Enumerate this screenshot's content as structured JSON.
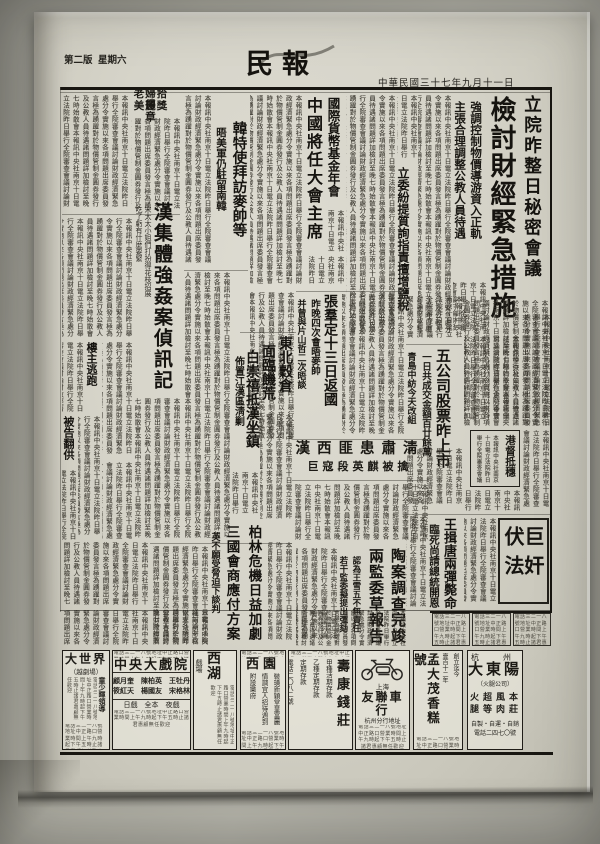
{
  "masthead": {
    "edition": "第二版",
    "weekday": "星期六",
    "title": "民報",
    "date_line": "中華民國三十七年九月十一日"
  },
  "texture": {
    "body": "本報訊中央社南京十日電立法院昨日舉行全院審查會議討論財政經濟緊急處分令實施以來各項問題出席委員發言極為踴躍對於物價管制金圓券發行及公教人員待遇諸問題詳加檢討至晚七時始散會",
    "tiny": "電話三二一八號地址中正路口營業時間上午九時起下午五時止諸君惠顧無任歡迎"
  },
  "articles": {
    "lead_kicker": "立院昨整日秘密會議",
    "lead_headline": "檢討財經緊急措施",
    "lead_sub1": "強調控制物價導游資入正軌",
    "lead_sub2": "主張合理調整公教人員待遇",
    "salt_tax": "立委紛提質詢指責擅增鹽稅",
    "imf_kicker": "國際貨幣基金年會",
    "imf_headline": "中國將任大會主席",
    "korea_headline": "韓特使拜訪麥帥等",
    "korea_sub": "晤美軍仍駐留南韓",
    "medal_line1": "老婦拾得",
    "medal_line2": "美麗獎章",
    "rape_headline": "漢集體強姦案偵訊記",
    "rape_intro1": "宋太太小姐們打扮得花枝招展",
    "rape_intro2": "吃了虧有什麼要緊",
    "rape_sub1": "樓主逃跑",
    "rape_sub2": "被告翻供",
    "zhangqun_headline": "張羣定十三日返國",
    "zhangqun_sub1": "昨晚四次會晤麥帥",
    "zhangqun_sub2": "并曾與片山哲二次晤談",
    "granary_line1": "東北穀倉",
    "granary_line2": "面臨饑荒",
    "bai_headline": "白崇禧抵漢坐鎮",
    "bai_sub": "佈置江漢區淸剿",
    "bandit_headline": "漢西匪患肅淸",
    "bandit_sub": "巨寇段英麒被擒",
    "stocks_headline": "五公司股票昨上市",
    "stocks_sub1": "一日共成交金額百廿餘萬",
    "stocks_sub2": "青島中紡今天改組",
    "hk_box": "港督抵穗",
    "traitor_box": "巨奸伏法",
    "traitor_headline": "王揖唐兩彈斃命",
    "traitor_sub": "臨死尚請總統開恩",
    "tao_line1": "陶案調查完竣",
    "tao_line2": "兩監委草報告",
    "tao_sub1": "認為王雪五不無責任",
    "tao_sub2": "若干監委擬提出彈劾",
    "berlin_line1": "柏林危機日益加劇",
    "berlin_line2": "三國會商應付方案",
    "berlin_sub": "英不願受脅迫下談判"
  },
  "ads": {
    "dashijie_name": "大世界",
    "dashijie_sub": "（越劇場）",
    "dashijie_line": "童少暉領導",
    "zhongyang_name": "中央大戲院",
    "zhongyang_cast1": "顧月奎　陳柏英　王牡丹",
    "zhongyang_cast2": "筱紅天　楊國友　宋格林",
    "zhongyang_bottom": "日戲　全本　夜戲",
    "xihu_name": "西湖",
    "xihu_sub": "戲場",
    "xiyuan_name": "西園",
    "xiyuan_line1": "裝璜新穎堂皇富麗",
    "xiyuan_line2": "情調宜人招待週到",
    "xiyuan_line3": "附設樂府",
    "shoukang_name": "壽康錢莊",
    "shoukang_line1": "甲種活期存款",
    "shoukang_line2": "乙種定期存款",
    "shoukang_line3": "定期存款",
    "shoukang_line4": "電話二〇八二號",
    "youlian_region": "上海",
    "youlian_name": "友聯車行",
    "youlian_branch": "杭州分行地址",
    "mengdamao_kicker1": "創立迄今",
    "mengdamao_kicker2": "壹百十二年",
    "mengdamao_name": "孟大茂香糕號",
    "mengdamao_line1": "※土產馳譽",
    "mengdamao_line2": "※獨步第一",
    "dadongyang_region": "杭　州",
    "dadongyang_name": "大東陽",
    "dadongyang_sub": "（火腿公司）",
    "dadongyang_products": "本莊風肉超等火腿",
    "dadongyang_line": "自製・自運・自銷",
    "dadongyang_phone": "電話二四七〇號"
  }
}
